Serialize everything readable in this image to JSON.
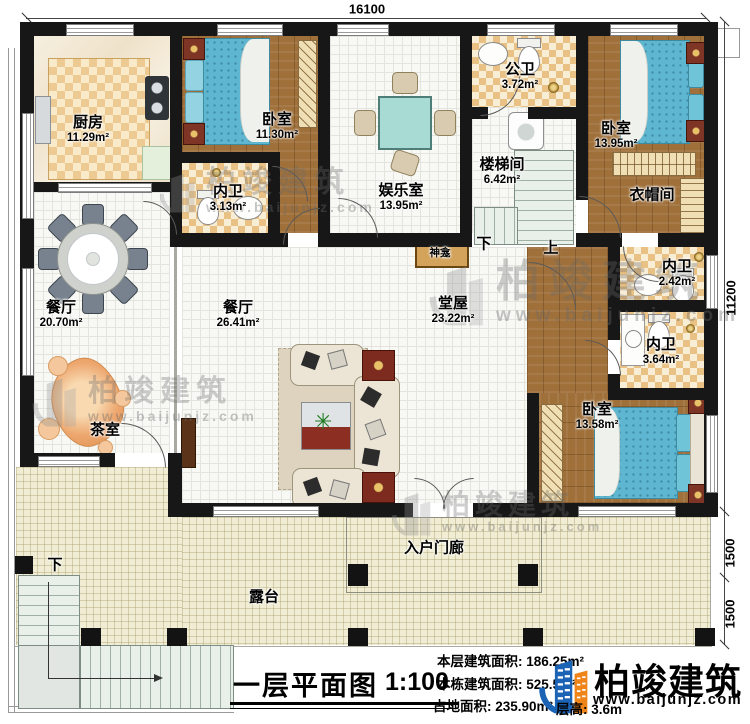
{
  "plan": {
    "title": "一层平面图",
    "scale": "1:100",
    "stats": [
      {
        "label": "本层建筑面积:",
        "value": "186.25m²"
      },
      {
        "label": "本栋建筑面积:",
        "value": "525.5m²"
      },
      {
        "label": "占地面积:",
        "value": "235.90m²"
      },
      {
        "label": "层高:",
        "value": "3.6m"
      }
    ]
  },
  "brand": {
    "name": "柏竣建筑",
    "url": "www.baijunjz.com"
  },
  "watermark": {
    "name": "柏竣建筑",
    "url": "www.baijunjz.com"
  },
  "dimensions": [
    {
      "text": "16100",
      "x": 367,
      "y": 9,
      "rot": false
    },
    {
      "text": "11200",
      "x": 731,
      "y": 298,
      "rot": true
    },
    {
      "text": "1500",
      "x": 730,
      "y": 553,
      "rot": true
    },
    {
      "text": "1500",
      "x": 730,
      "y": 614,
      "rot": true
    }
  ],
  "rooms": [
    {
      "name": "厨房",
      "area": "11.29m²",
      "x": 88,
      "y": 130
    },
    {
      "name": "卧室",
      "area": "11.30m²",
      "x": 277,
      "y": 127
    },
    {
      "name": "内卫",
      "area": "3.13m²",
      "x": 228,
      "y": 199
    },
    {
      "name": "娱乐室",
      "area": "13.95m²",
      "x": 401,
      "y": 198
    },
    {
      "name": "公卫",
      "area": "3.72m²",
      "x": 520,
      "y": 77
    },
    {
      "name": "楼梯间",
      "area": "6.42m²",
      "x": 502,
      "y": 172
    },
    {
      "name": "卧室",
      "area": "13.95m²",
      "x": 616,
      "y": 136
    },
    {
      "name": "衣帽间",
      "area": "",
      "x": 652,
      "y": 196
    },
    {
      "name": "餐厅",
      "area": "20.70m²",
      "x": 61,
      "y": 315
    },
    {
      "name": "餐厅",
      "area": "26.41m²",
      "x": 238,
      "y": 315
    },
    {
      "name": "堂屋",
      "area": "23.22m²",
      "x": 453,
      "y": 311
    },
    {
      "name": "内卫",
      "area": "2.42m²",
      "x": 677,
      "y": 274
    },
    {
      "name": "内卫",
      "area": "3.64m²",
      "x": 661,
      "y": 352
    },
    {
      "name": "卧室",
      "area": "13.58m²",
      "x": 597,
      "y": 417
    },
    {
      "name": "茶室",
      "area": "",
      "x": 105,
      "y": 431
    },
    {
      "name": "神龛",
      "area": "",
      "x": 440,
      "y": 254,
      "cls": "sm"
    },
    {
      "name": "下",
      "area": "",
      "x": 484,
      "y": 245
    },
    {
      "name": "上",
      "area": "",
      "x": 551,
      "y": 249
    },
    {
      "name": "下",
      "area": "",
      "x": 55,
      "y": 566
    },
    {
      "name": "露台",
      "area": "",
      "x": 264,
      "y": 598
    },
    {
      "name": "入户门廊",
      "area": "",
      "x": 434,
      "y": 549
    }
  ]
}
